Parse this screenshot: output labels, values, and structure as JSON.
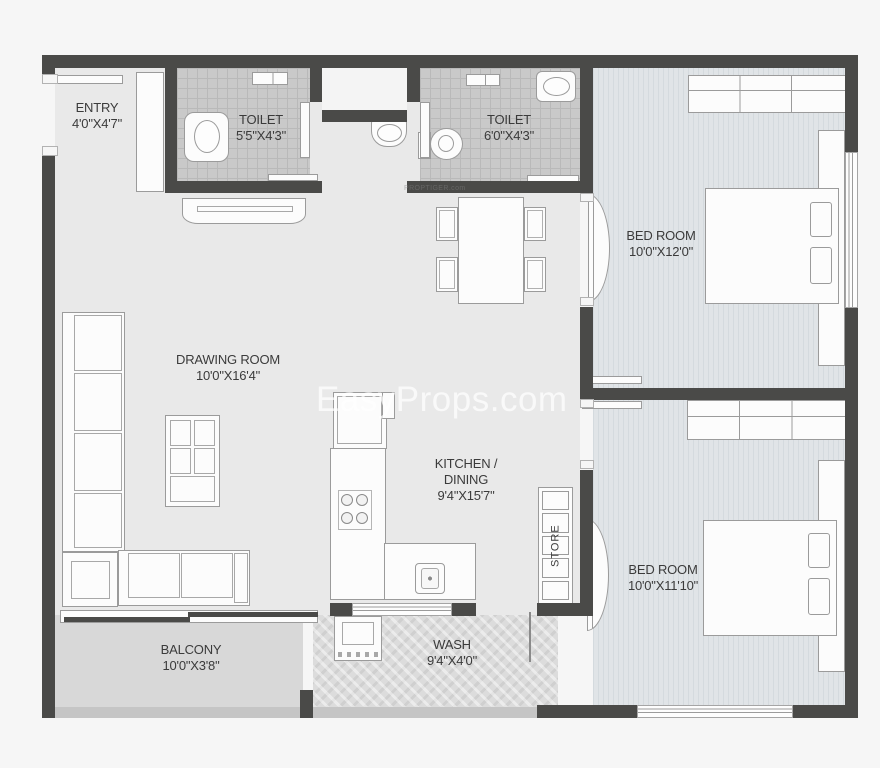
{
  "rooms": {
    "entry": {
      "name": "ENTRY",
      "dims": "4'0\"X4'7\""
    },
    "toilet_1": {
      "name": "TOILET",
      "dims": "5'5\"X4'3\""
    },
    "toilet_2": {
      "name": "TOILET",
      "dims": "6'0\"X4'3\""
    },
    "bedroom_1": {
      "name": "BED ROOM",
      "dims": "10'0\"X12'0\""
    },
    "drawing_room": {
      "name": "DRAWING ROOM",
      "dims": "10'0\"X16'4\""
    },
    "kitchen": {
      "name_line_1": "KITCHEN /",
      "name_line_2": "DINING",
      "dims": "9'4\"X15'7\""
    },
    "bedroom_2": {
      "name": "BED ROOM",
      "dims": "10'0\"X11'10\""
    },
    "balcony": {
      "name": "BALCONY",
      "dims": "10'0\"X3'8\""
    },
    "wash": {
      "name": "WASH",
      "dims": "9'4\"X4'0\""
    },
    "store": {
      "name": "STORE"
    }
  },
  "watermarks": {
    "primary": "EasyProps.com",
    "secondary": "PROPTIGER.com"
  },
  "colors": {
    "wall": "#4a4a48",
    "floor_main": "#e9e9e9",
    "floor_bedroom": "#e0e4e7",
    "floor_toilet": "#c9c9c9",
    "floor_balcony": "#d8d8d8",
    "floor_wash": "#dcdcdc",
    "furniture_fill": "#fcfcfc",
    "furniture_line": "#9b9b9b",
    "label_text": "#3b3b3b",
    "background": "#f6f6f6"
  }
}
